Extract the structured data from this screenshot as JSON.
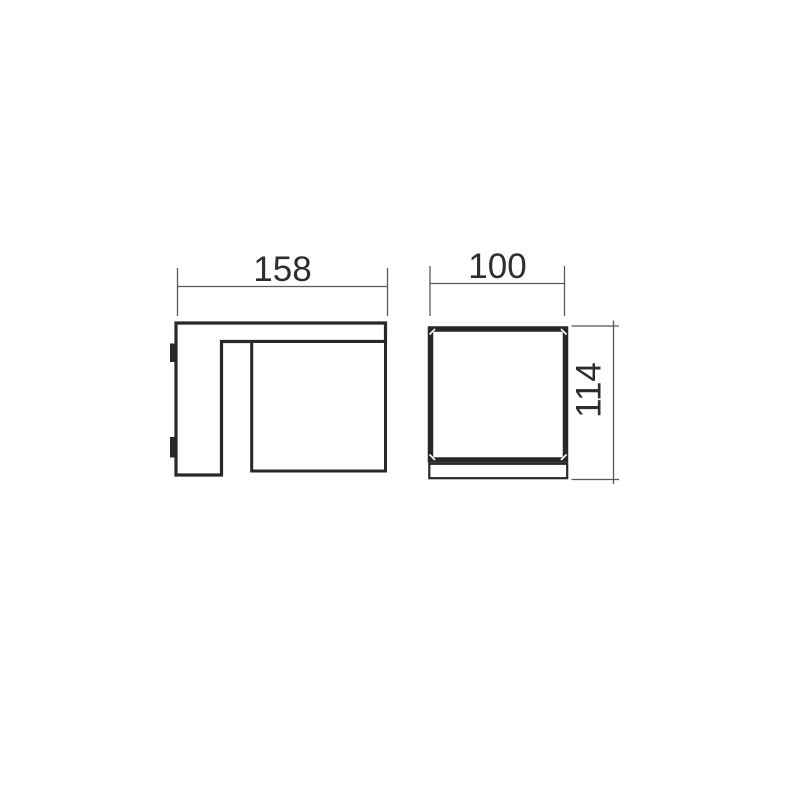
{
  "drawing": {
    "labels": {
      "side_width": "158",
      "front_width": "100",
      "front_height": "114"
    },
    "colors": {
      "background": "#ffffff",
      "outline": "#28282a",
      "dimension_line": "#58585a",
      "label_text": "#2d2d2d"
    }
  }
}
